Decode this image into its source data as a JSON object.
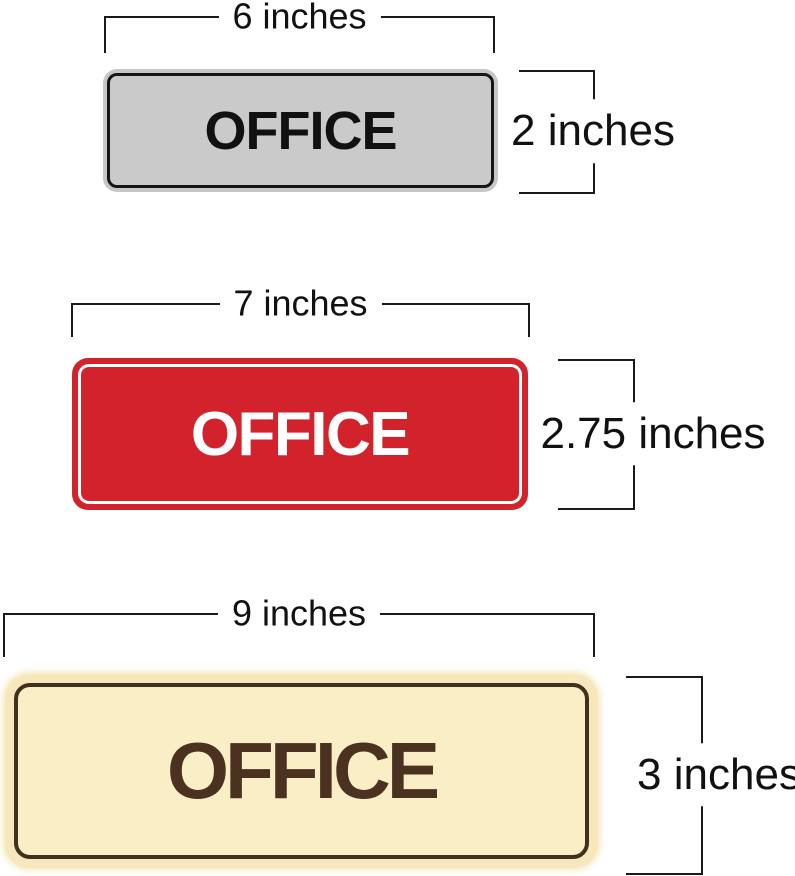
{
  "figure": {
    "background": "#ffffff",
    "dimension_style": {
      "line_color": "#1a1a1a",
      "label_color": "#111111"
    }
  },
  "signs": [
    {
      "id": "silver-office-sign",
      "text": "OFFICE",
      "width_label": "6 inches",
      "height_label": "2 inches",
      "colors": {
        "rim": "#C7C7C7",
        "face": "#CACACA",
        "outline": "#161616",
        "text": "#111111"
      }
    },
    {
      "id": "red-office-sign",
      "text": "OFFICE",
      "width_label": "7 inches",
      "height_label": "2.75 inches",
      "colors": {
        "face": "#D2232C",
        "pinstripe": "#FFFFFF",
        "text": "#FFFFFF"
      }
    },
    {
      "id": "cream-office-sign",
      "text": "OFFICE",
      "width_label": "9 inches",
      "height_label": "3 inches",
      "colors": {
        "glow": "#F6E8BC",
        "face": "#FAEEC6",
        "outline": "#42301E",
        "text": "#4A3120"
      }
    }
  ]
}
